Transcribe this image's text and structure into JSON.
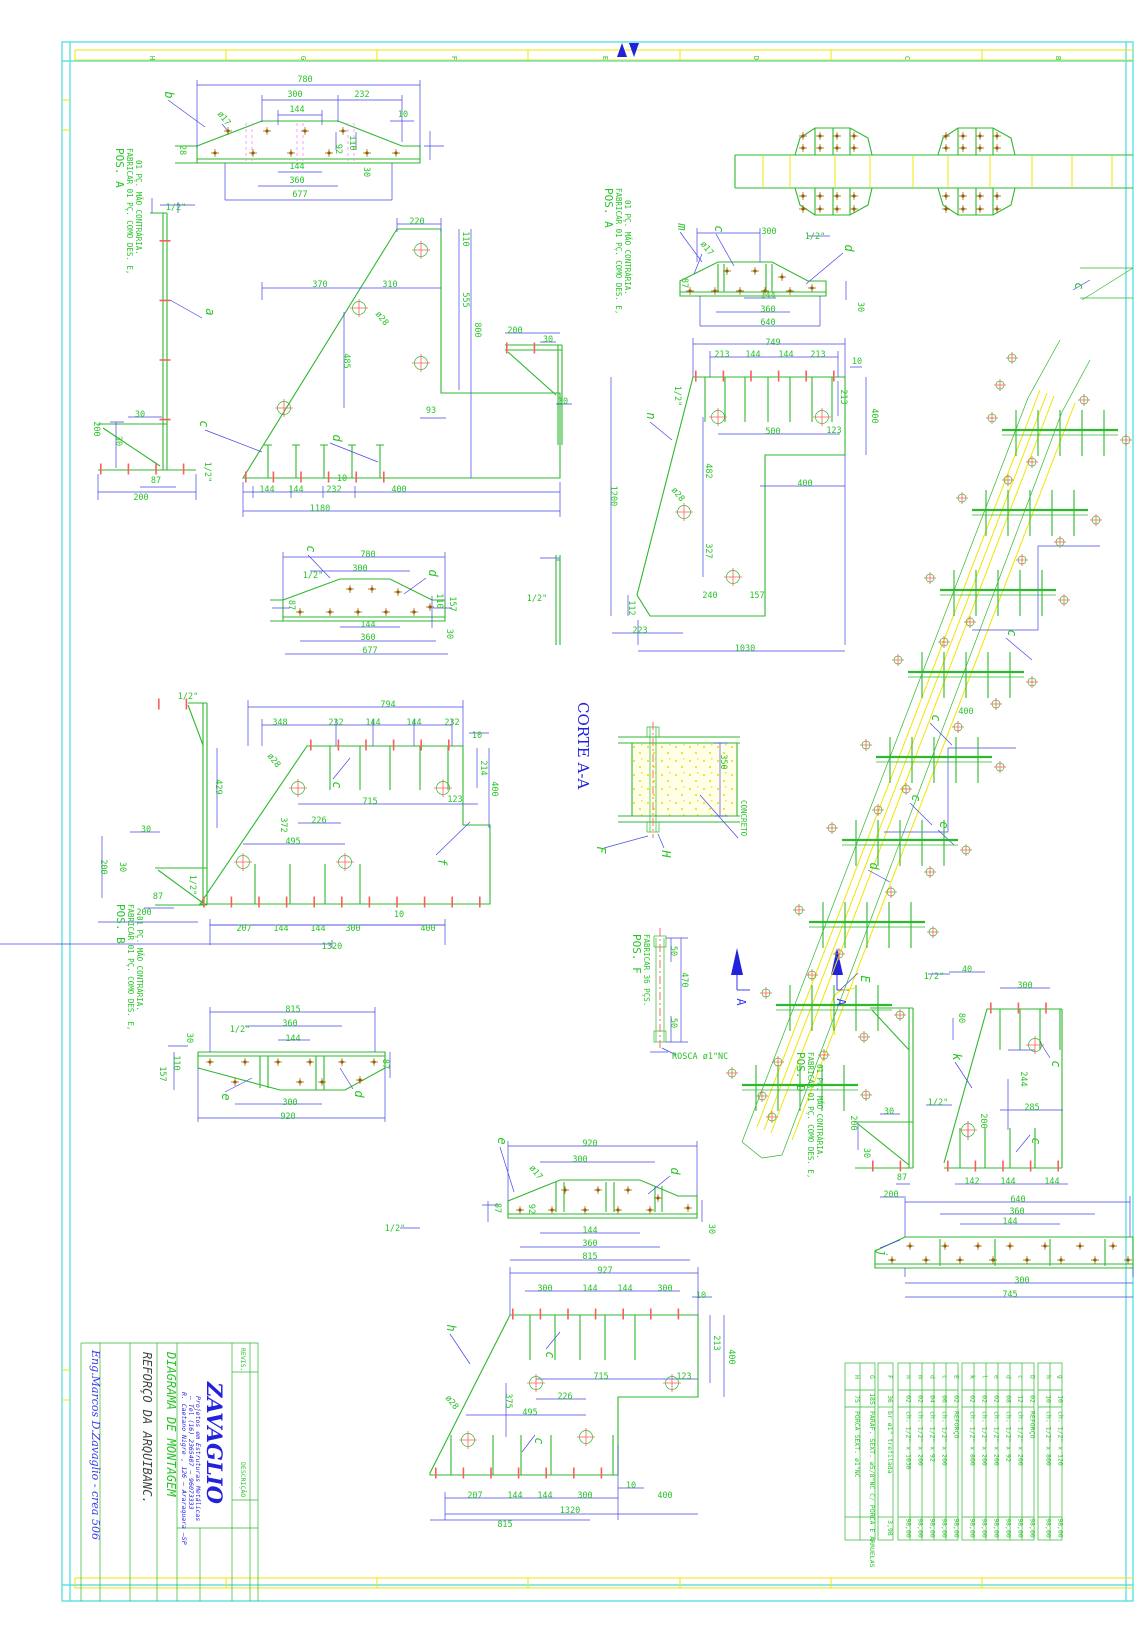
{
  "sheet": {
    "grid_letters_top": [
      "H",
      "G",
      "F",
      "E",
      "D",
      "C",
      "B"
    ],
    "colors": {
      "part": "#2eb82e",
      "dimension": "#4646e8",
      "annotation": "#27c427",
      "weld": "#ff5c5c",
      "bolt": "#9a5d00",
      "concrete_band": "#f2e500",
      "frame": "#49dada",
      "title_blue": "#2222dd"
    }
  },
  "title_block": {
    "company": "ZAVAGLIO",
    "addr1": "Projetos em Estruturas Metálicas",
    "addr2": "— Tel (16) 2365407 — 96073333",
    "addr3": "R. Caetano Nigre , 126 — Araraquara —SP",
    "doc_type": "DIAGRAMA DE MONTAGEM",
    "subject": "REFORÇO DA ARQUIBANC.",
    "engineer": "Eng.Marcos D.Zavaglio - crea 506",
    "revis_label": "REVIS.",
    "descr_label": "DESCRIÇÃO"
  },
  "section": {
    "corte_title": "CORTE A-A",
    "concreto": "CONCRETO",
    "rosca": "ROSCA ø1\"NC"
  },
  "pos_labels": [
    {
      "x": 116,
      "y": 148,
      "title": "POS. A",
      "lines": [
        "FABRICAR 01 PÇ. COMO DES. E,",
        "01 PÇ. MÃO CONTRÁRIA."
      ]
    },
    {
      "x": 605,
      "y": 188,
      "title": "POS. A",
      "lines": [
        "FABRICAR 01 PÇ. COMO DES. E,",
        "01 PÇ. MÃO CONTRÁRIA."
      ]
    },
    {
      "x": 117,
      "y": 904,
      "title": "POS. B",
      "lines": [
        "FABRICAR 01 PÇ. COMO DES. E,",
        "01 PÇ. MÃO CONTRÁRIA."
      ]
    },
    {
      "x": 633,
      "y": 934,
      "title": "POS. F",
      "lines": [
        "FABRICAR 36 PÇS."
      ]
    },
    {
      "x": 797,
      "y": 1052,
      "title": "POS. D",
      "lines": [
        "FABRICAR 01 PÇ. COMO DES. E,",
        "01 PÇ. MÃO CONTRÁRIA."
      ]
    }
  ],
  "parts_tables": [
    {
      "x": 845,
      "row_w": 15,
      "rows": [
        [
          "H",
          "75",
          "PORCA SEXT. ø1\"NC",
          ""
        ],
        [
          "G",
          "185",
          "PARAF. SEXT. ø5/8\"NC C/ PORCA E ARRUELAS",
          ""
        ]
      ]
    },
    {
      "x": 878,
      "row_w": 15,
      "rows": [
        [
          "F",
          "36",
          "br ø1\" trefilada",
          "3,98"
        ]
      ]
    },
    {
      "x": 898,
      "row_w": 12,
      "rows": [
        [
          "n",
          "02",
          "ch. 1/2\" x 1030",
          "98,00"
        ],
        [
          "m",
          "02",
          "ch. 1/2\" x 200",
          "98,00"
        ],
        [
          "d",
          "04",
          "ch. 1/2\" x 92",
          "98,00"
        ],
        [
          "c",
          "06",
          "ch. 1/2\" x 200",
          "98,00"
        ],
        [
          "E",
          "02",
          "REFORÇO",
          "98,00"
        ]
      ]
    },
    {
      "x": 962,
      "row_w": 12,
      "rows": [
        [
          "k",
          "02",
          "ch. 1/2\" x 800",
          "98,00"
        ],
        [
          "l",
          "02",
          "ch. 1/2\" x 200",
          "98,00"
        ],
        [
          "e",
          "02",
          "ch. 1/2\" x 200",
          "98,00"
        ],
        [
          "d",
          "08",
          "ch. 1/2\" x 92",
          "98,00"
        ],
        [
          "c",
          "12",
          "ch. 1/2\" x 200",
          "98,00"
        ],
        [
          "D",
          "02",
          "REFORÇO",
          "98,00"
        ]
      ]
    },
    {
      "x": 1038,
      "row_w": 12,
      "rows": [
        [
          "h",
          "10",
          "ch. 1/2\" x 800",
          "98,00"
        ],
        [
          "g",
          "10",
          "ch. 1/2\" x 120",
          "98,00"
        ]
      ]
    }
  ],
  "annotations": [
    [
      "780",
      305,
      82
    ],
    [
      "300",
      295,
      97
    ],
    [
      "232",
      362,
      97
    ],
    [
      "144",
      297,
      112
    ],
    [
      "10",
      403,
      117
    ],
    [
      "144",
      297,
      169
    ],
    [
      "360",
      297,
      183
    ],
    [
      "677",
      300,
      197
    ],
    [
      "28",
      180,
      150,
      90
    ],
    [
      "92",
      336,
      149,
      90
    ],
    [
      "110",
      350,
      143,
      90
    ],
    [
      "30",
      364,
      172,
      90
    ],
    [
      "b",
      165,
      95,
      90,
      "lb"
    ],
    [
      "ø17",
      222,
      120,
      52
    ],
    [
      "1/2\"",
      176,
      210
    ],
    [
      "a",
      206,
      312,
      90,
      "lb"
    ],
    [
      "30",
      140,
      417
    ],
    [
      "30",
      116,
      441,
      90
    ],
    [
      "87",
      156,
      483
    ],
    [
      "200",
      141,
      500
    ],
    [
      "200",
      94,
      429,
      90
    ],
    [
      "220",
      417,
      224
    ],
    [
      "110",
      463,
      239,
      90
    ],
    [
      "555",
      463,
      300,
      90
    ],
    [
      "800",
      475,
      330,
      90
    ],
    [
      "370",
      320,
      287
    ],
    [
      "310",
      390,
      287
    ],
    [
      "ø28",
      380,
      320,
      52
    ],
    [
      "485",
      344,
      361,
      90
    ],
    [
      "93",
      431,
      413
    ],
    [
      "10",
      342,
      481
    ],
    [
      "144",
      267,
      492
    ],
    [
      "144",
      296,
      492
    ],
    [
      "232",
      334,
      492
    ],
    [
      "400",
      399,
      492
    ],
    [
      "1180",
      320,
      511
    ],
    [
      "1/2\"",
      205,
      472,
      90
    ],
    [
      "c",
      200,
      424,
      90,
      "lb"
    ],
    [
      "d",
      333,
      438,
      90,
      "lb"
    ],
    [
      "780",
      368,
      557
    ],
    [
      "300",
      360,
      571
    ],
    [
      "1/2\"",
      313,
      578
    ],
    [
      "110",
      437,
      601,
      90
    ],
    [
      "157",
      450,
      604,
      90
    ],
    [
      "144",
      368,
      627
    ],
    [
      "360",
      368,
      640
    ],
    [
      "677",
      370,
      653
    ],
    [
      "30",
      447,
      634,
      90
    ],
    [
      "c",
      307,
      549,
      90,
      "lb"
    ],
    [
      "d",
      429,
      573,
      90,
      "lb"
    ],
    [
      "87",
      289,
      605,
      90
    ],
    [
      "1/2\"",
      188,
      699
    ],
    [
      "794",
      388,
      707
    ],
    [
      "348",
      280,
      725
    ],
    [
      "232",
      336,
      725
    ],
    [
      "144",
      373,
      725
    ],
    [
      "144",
      414,
      725
    ],
    [
      "232",
      452,
      725
    ],
    [
      "10",
      477,
      738
    ],
    [
      "214",
      481,
      768,
      90
    ],
    [
      "400",
      492,
      789,
      90
    ],
    [
      "429",
      216,
      787,
      90
    ],
    [
      "ø28",
      272,
      762,
      52
    ],
    [
      "c",
      333,
      785,
      90,
      "lb"
    ],
    [
      "715",
      370,
      804
    ],
    [
      "123",
      455,
      802
    ],
    [
      "372",
      281,
      825,
      90
    ],
    [
      "226",
      319,
      823
    ],
    [
      "495",
      293,
      844
    ],
    [
      "f",
      438,
      862,
      90,
      "lb"
    ],
    [
      "30",
      146,
      832
    ],
    [
      "30",
      120,
      867,
      90
    ],
    [
      "87",
      158,
      899
    ],
    [
      "200",
      144,
      915
    ],
    [
      "200",
      101,
      867,
      90
    ],
    [
      "1/2\"",
      190,
      885,
      90
    ],
    [
      "207",
      244,
      931
    ],
    [
      "144",
      281,
      931
    ],
    [
      "144",
      318,
      931
    ],
    [
      "300",
      353,
      931
    ],
    [
      "10",
      399,
      917
    ],
    [
      "400",
      428,
      931
    ],
    [
      "1320",
      332,
      949
    ],
    [
      "815",
      293,
      1012
    ],
    [
      "360",
      290,
      1026
    ],
    [
      "1/2\"",
      240,
      1032
    ],
    [
      "144",
      293,
      1041
    ],
    [
      "30",
      187,
      1038,
      90
    ],
    [
      "110",
      174,
      1063,
      90
    ],
    [
      "157",
      160,
      1074,
      90
    ],
    [
      "87",
      383,
      1064,
      90
    ],
    [
      "e",
      222,
      1097,
      90,
      "lb"
    ],
    [
      "d",
      355,
      1094,
      90,
      "lb"
    ],
    [
      "300",
      290,
      1105
    ],
    [
      "920",
      288,
      1119
    ],
    [
      "m",
      678,
      227,
      90,
      "lb"
    ],
    [
      "c",
      715,
      229,
      90,
      "lb"
    ],
    [
      "ø17",
      705,
      250,
      52
    ],
    [
      "300",
      769,
      234
    ],
    [
      "1/2\"",
      815,
      239
    ],
    [
      "d",
      845,
      248,
      90,
      "lb"
    ],
    [
      "87",
      682,
      283,
      90
    ],
    [
      "144",
      768,
      298
    ],
    [
      "360",
      768,
      312
    ],
    [
      "640",
      768,
      325
    ],
    [
      "30",
      858,
      307,
      90
    ],
    [
      "749",
      773,
      345
    ],
    [
      "213",
      722,
      357
    ],
    [
      "144",
      753,
      357
    ],
    [
      "144",
      786,
      357
    ],
    [
      "213",
      818,
      357
    ],
    [
      "10",
      857,
      364
    ],
    [
      "1/2\"",
      675,
      396,
      90
    ],
    [
      "213",
      841,
      397,
      90
    ],
    [
      "400",
      872,
      416,
      90
    ],
    [
      "n",
      647,
      416,
      90,
      "lb"
    ],
    [
      "500",
      773,
      434
    ],
    [
      "123",
      834,
      433
    ],
    [
      "482",
      706,
      471,
      90
    ],
    [
      "400",
      805,
      486
    ],
    [
      "ø28",
      676,
      496,
      52
    ],
    [
      "1200",
      611,
      496,
      90
    ],
    [
      "327",
      706,
      551,
      90
    ],
    [
      "240",
      710,
      598
    ],
    [
      "157",
      757,
      598
    ],
    [
      "112",
      629,
      608,
      90
    ],
    [
      "223",
      640,
      633
    ],
    [
      "1030",
      745,
      651
    ],
    [
      "200",
      515,
      333
    ],
    [
      "30",
      548,
      342
    ],
    [
      "30",
      563,
      404
    ],
    [
      "1/2\"",
      537,
      601
    ],
    [
      "350",
      721,
      762,
      90
    ],
    [
      "F",
      597,
      850,
      90,
      "lb"
    ],
    [
      "H",
      662,
      854,
      90,
      "lb"
    ],
    [
      "50",
      671,
      951,
      90
    ],
    [
      "470",
      682,
      980,
      90
    ],
    [
      "50",
      671,
      1023,
      90
    ],
    [
      "A",
      737,
      1002,
      90,
      "bl"
    ],
    [
      "A",
      837,
      1002,
      90,
      "bl"
    ],
    [
      "400",
      966,
      714
    ],
    [
      "c",
      1008,
      633,
      90,
      "lb"
    ],
    [
      "c",
      932,
      718,
      90,
      "lb"
    ],
    [
      "c",
      912,
      798,
      90,
      "lb"
    ],
    [
      "e",
      940,
      825,
      90,
      "lb"
    ],
    [
      "d",
      870,
      866,
      90,
      "lb"
    ],
    [
      "E",
      861,
      979,
      90,
      "lb"
    ],
    [
      "c",
      1075,
      286,
      90,
      "lb"
    ],
    [
      "e",
      498,
      1141,
      90,
      "lb"
    ],
    [
      "920",
      590,
      1146
    ],
    [
      "300",
      580,
      1162
    ],
    [
      "ø17",
      534,
      1174,
      52
    ],
    [
      "d",
      671,
      1171,
      90,
      "lb"
    ],
    [
      "87",
      495,
      1208,
      90
    ],
    [
      "92",
      529,
      1209,
      90
    ],
    [
      "144",
      590,
      1233
    ],
    [
      "360",
      590,
      1246
    ],
    [
      "815",
      590,
      1259
    ],
    [
      "30",
      709,
      1229,
      90
    ],
    [
      "1/2\"",
      395,
      1231
    ],
    [
      "927",
      605,
      1273
    ],
    [
      "300",
      545,
      1291
    ],
    [
      "144",
      590,
      1291
    ],
    [
      "144",
      625,
      1291
    ],
    [
      "300",
      665,
      1291
    ],
    [
      "10",
      701,
      1298
    ],
    [
      "h",
      447,
      1328,
      90,
      "lb"
    ],
    [
      "c",
      546,
      1355,
      90,
      "lb"
    ],
    [
      "213",
      714,
      1343,
      90
    ],
    [
      "400",
      729,
      1357,
      90
    ],
    [
      "715",
      601,
      1379
    ],
    [
      "123",
      684,
      1379
    ],
    [
      "375",
      506,
      1401,
      90
    ],
    [
      "226",
      565,
      1399
    ],
    [
      "495",
      530,
      1415
    ],
    [
      "ø28",
      450,
      1404,
      52
    ],
    [
      "c",
      535,
      1441,
      90,
      "lb"
    ],
    [
      "10",
      631,
      1488
    ],
    [
      "207",
      475,
      1498
    ],
    [
      "144",
      515,
      1498
    ],
    [
      "144",
      545,
      1498
    ],
    [
      "300",
      585,
      1498
    ],
    [
      "400",
      665,
      1498
    ],
    [
      "1320",
      570,
      1513
    ],
    [
      "815",
      505,
      1527
    ],
    [
      "1/2\"",
      934,
      979
    ],
    [
      "30",
      889,
      1114
    ],
    [
      "200",
      851,
      1123,
      90
    ],
    [
      "30",
      864,
      1153,
      90
    ],
    [
      "87",
      902,
      1180
    ],
    [
      "200",
      891,
      1197
    ],
    [
      "40",
      967,
      972
    ],
    [
      "300",
      1025,
      988
    ],
    [
      "80",
      959,
      1018,
      90
    ],
    [
      "k",
      953,
      1057,
      90,
      "lb"
    ],
    [
      "c",
      1052,
      1064,
      90,
      "lb"
    ],
    [
      "244",
      1021,
      1079,
      90
    ],
    [
      "285",
      1032,
      1110
    ],
    [
      "1/2\"",
      938,
      1105
    ],
    [
      "200",
      981,
      1121,
      90
    ],
    [
      "c",
      1032,
      1141,
      90,
      "lb"
    ],
    [
      "142",
      972,
      1184
    ],
    [
      "144",
      1008,
      1184
    ],
    [
      "144",
      1052,
      1184
    ],
    [
      "640",
      1018,
      1202
    ],
    [
      "360",
      1017,
      1214
    ],
    [
      "144",
      1010,
      1224
    ],
    [
      "300",
      1022,
      1283
    ],
    [
      "745",
      1010,
      1297
    ],
    [
      "j",
      878,
      1253,
      90,
      "lb"
    ]
  ]
}
